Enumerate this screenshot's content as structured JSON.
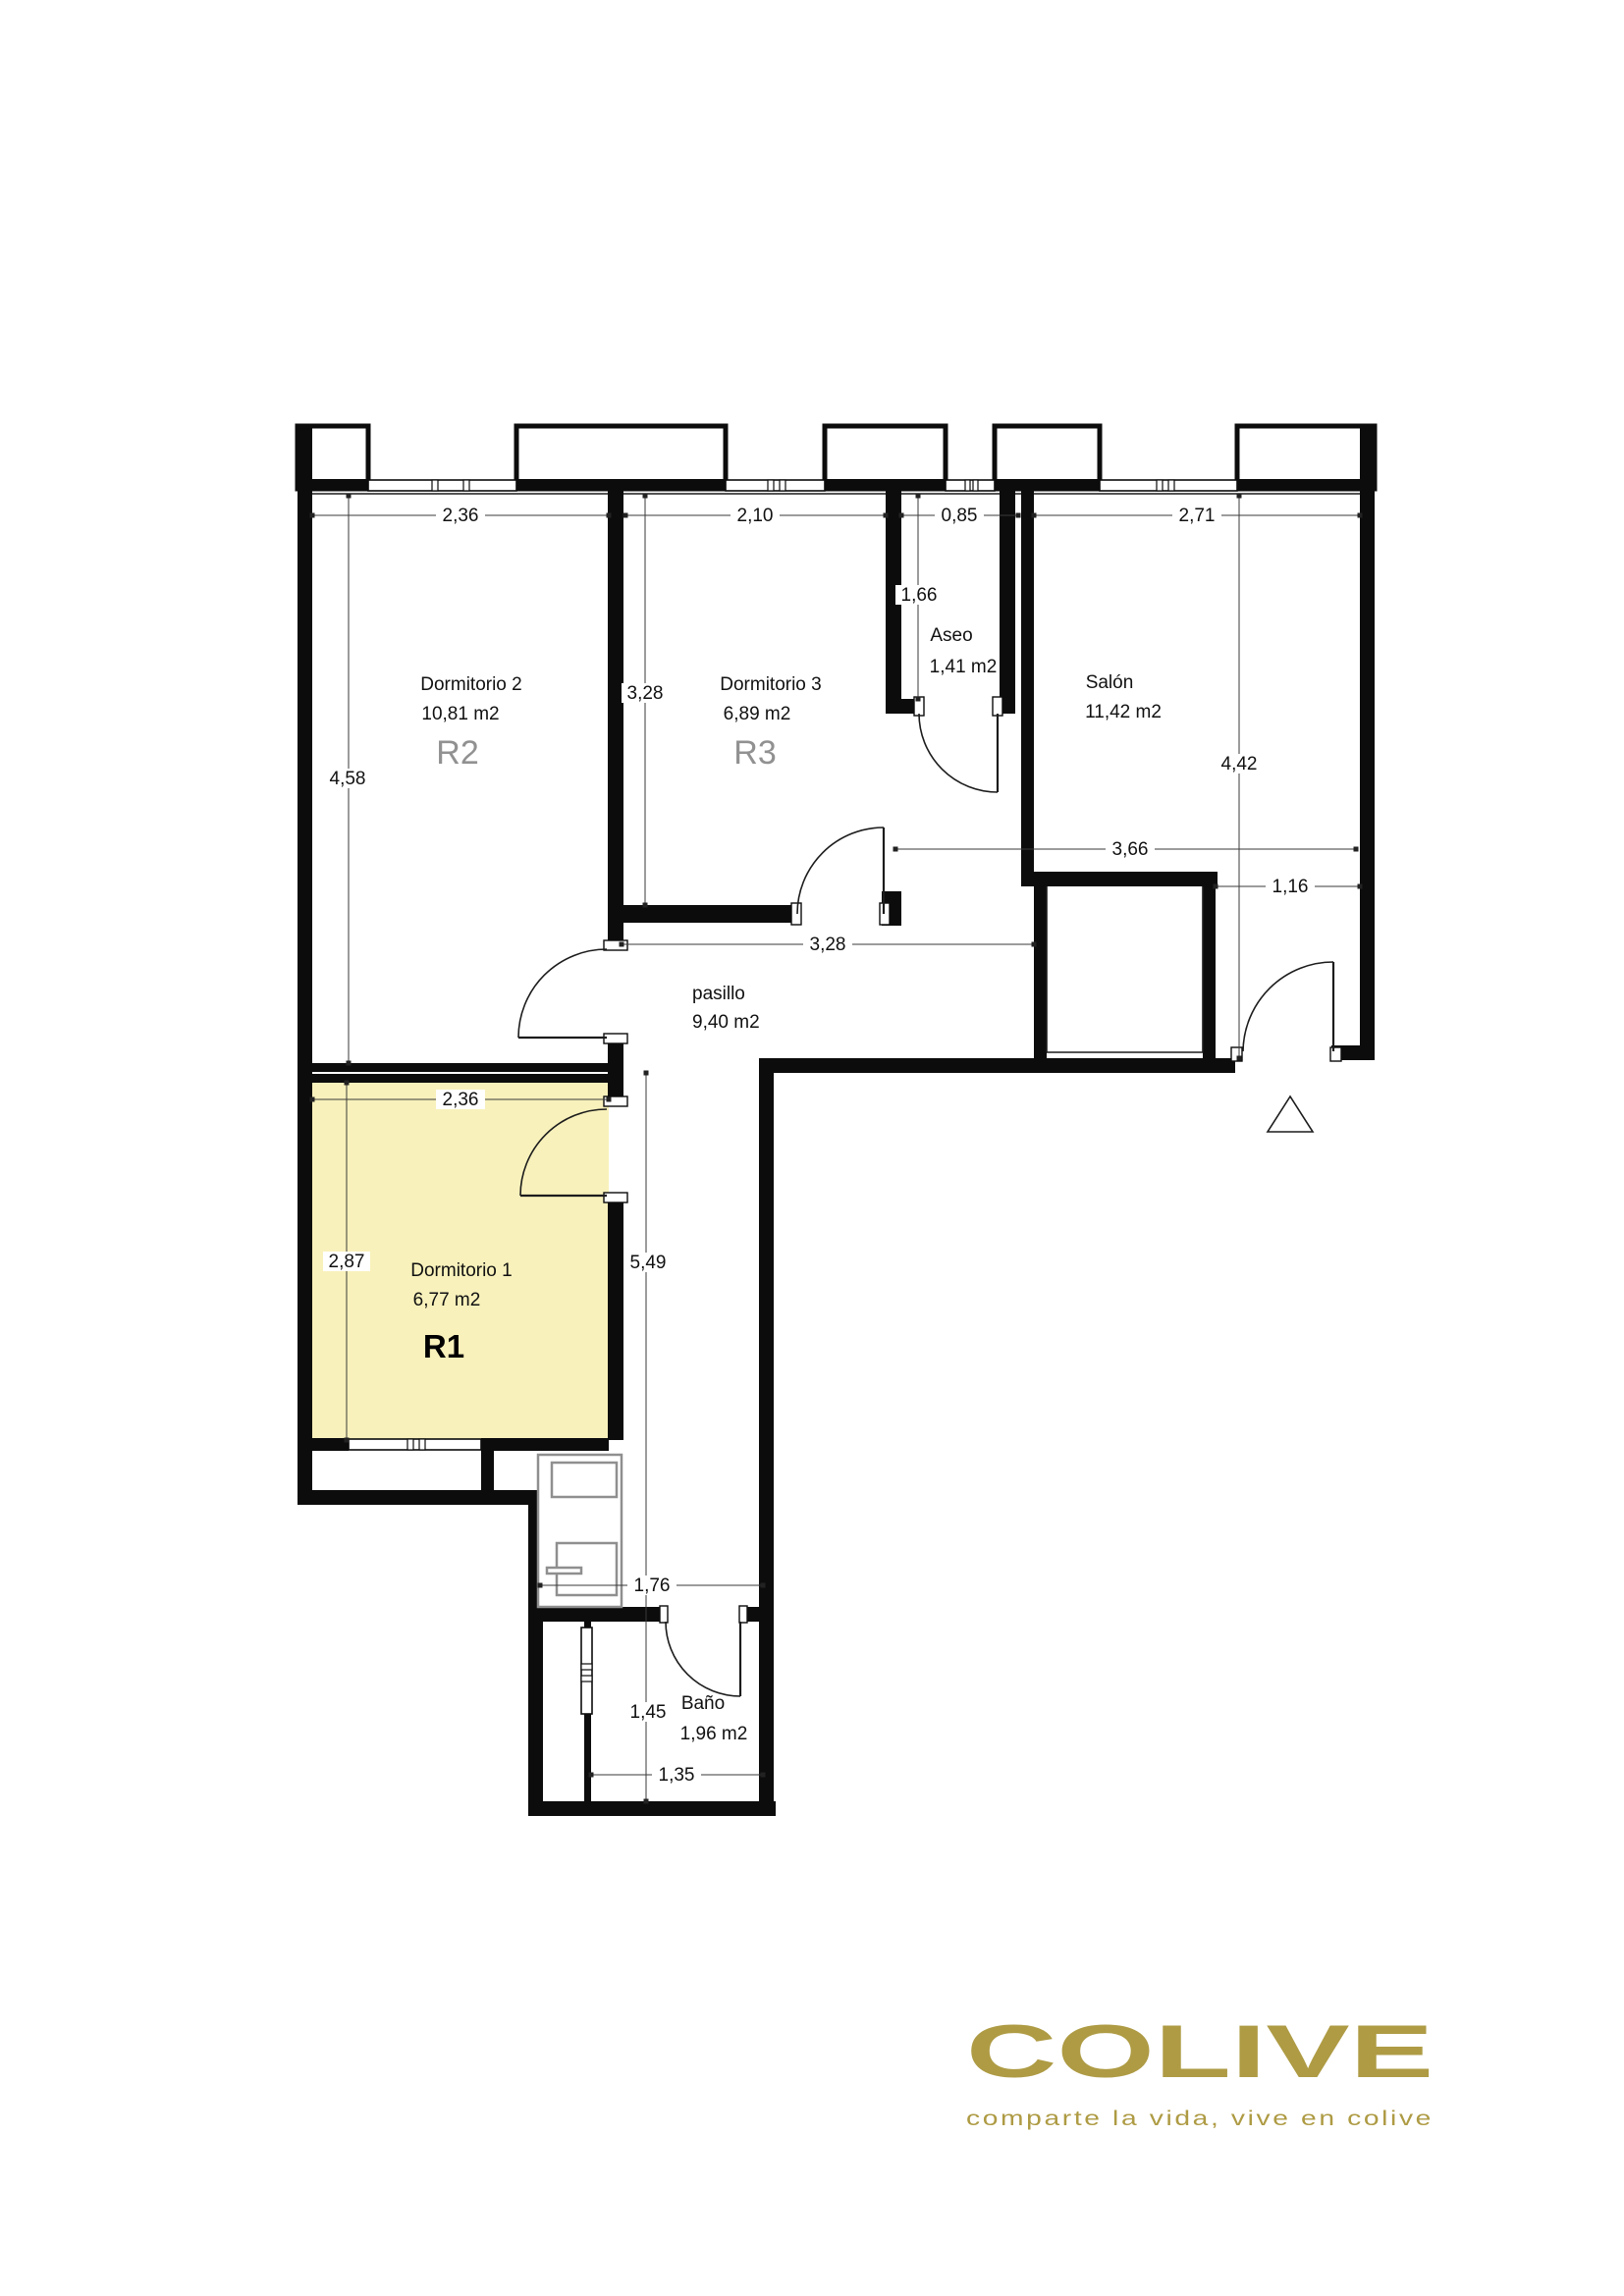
{
  "document": {
    "type": "floor-plan",
    "background": "#ffffff"
  },
  "colors": {
    "highlight_room_fill": "#F8F1BB",
    "wall": "#0c0c0c",
    "room_code_gray": "#919191",
    "logo_gold": "#AE9B44"
  },
  "rooms": {
    "d2": {
      "name": "Dormitorio 2",
      "area": "10,81 m2",
      "code": "R2"
    },
    "d3": {
      "name": "Dormitorio 3",
      "area": "6,89 m2",
      "code": "R3"
    },
    "aseo": {
      "name": "Aseo",
      "area": "1,41 m2"
    },
    "salon": {
      "name": "Salón",
      "area": "11,42 m2"
    },
    "pasillo": {
      "name": "pasillo",
      "area": "9,40 m2"
    },
    "d1": {
      "name": "Dormitorio 1",
      "area": "6,77 m2",
      "code": "R1"
    },
    "bano": {
      "name": "Baño",
      "area": "1,96 m2"
    }
  },
  "dims": {
    "d2_w": "2,36",
    "d3_w": "2,10",
    "aseo_w": "0,85",
    "salon_w": "2,71",
    "d2_h": "4,58",
    "d3_h": "3,28",
    "aseo_h": "1,66",
    "salon_h": "4,42",
    "salon_b": "3,66",
    "entry_w": "1,16",
    "pasillo_w": "3,28",
    "d1_w": "2,36",
    "d1_h": "2,87",
    "corridor_h": "5,49",
    "laundry_w": "1,76",
    "bano_h": "1,45",
    "bano_w": "1,35"
  },
  "logo": {
    "brand": "COLIVE",
    "tagline": "comparte la vida, vive en colive"
  }
}
